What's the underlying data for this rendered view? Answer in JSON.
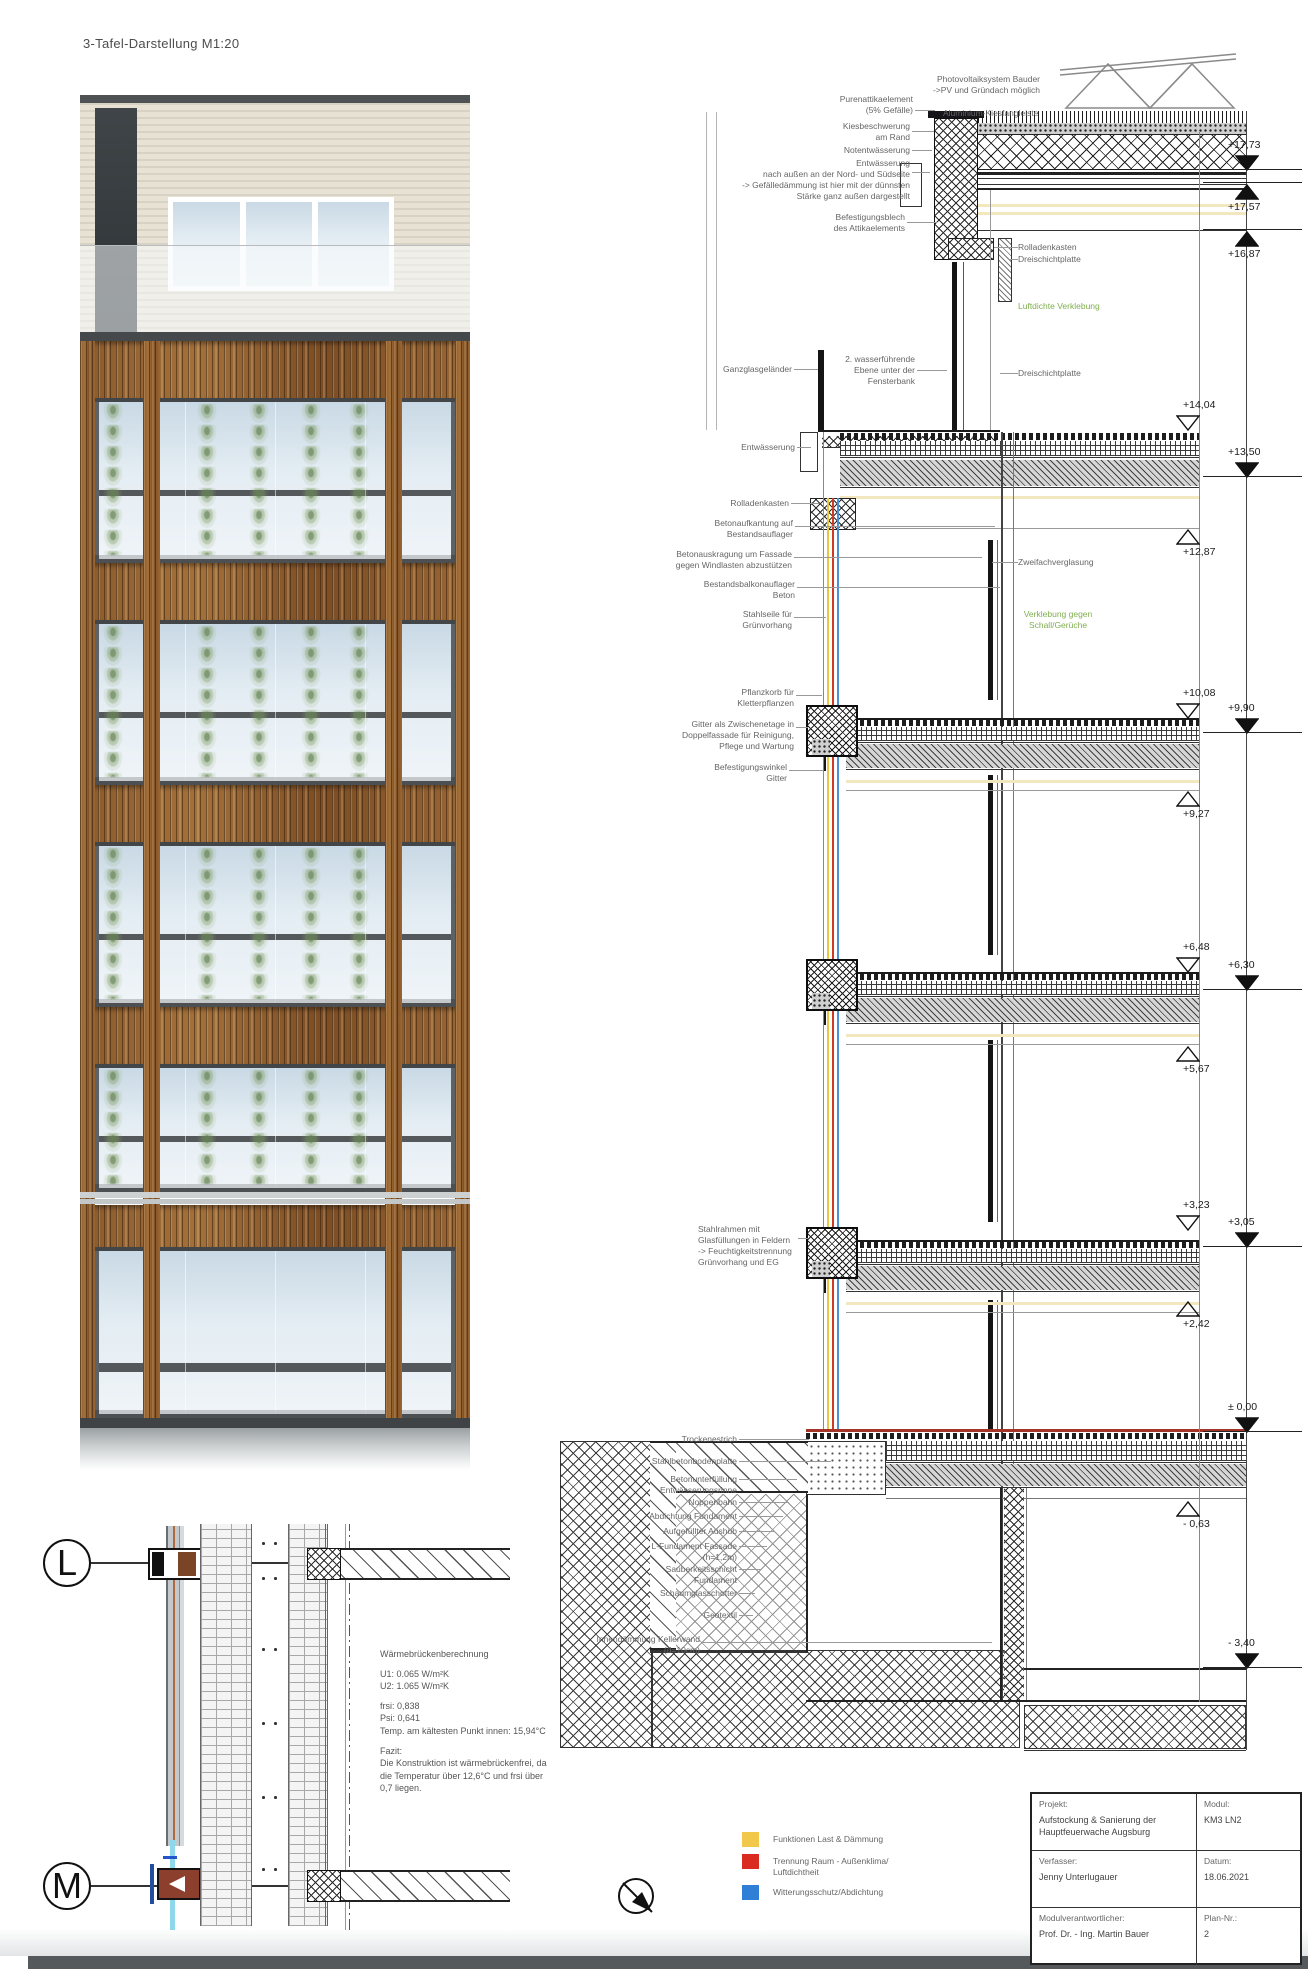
{
  "page": {
    "title": "3-Tafel-Darstellung M1:20"
  },
  "section": {
    "annotations": [
      {
        "t": "Photovoltaiksystem Bauder\n->PV und Gründach möglich",
        "x": 905,
        "y": 74,
        "w": 135,
        "a": "right",
        "lead": 0
      },
      {
        "t": "Purenattikaelement\n(5% Gefälle)",
        "x": 805,
        "y": 94,
        "w": 108,
        "a": "right",
        "lead": 20,
        "ldy": 16
      },
      {
        "t": "Aluminium-Kiesfangleiste",
        "x": 943,
        "y": 108,
        "w": 115,
        "a": "left",
        "lead": 0
      },
      {
        "t": "Kiesbeschwerung\nam Rand",
        "x": 800,
        "y": 121,
        "w": 110,
        "a": "right",
        "lead": 22,
        "ldy": 10
      },
      {
        "t": "Notentwässerung",
        "x": 800,
        "y": 145,
        "w": 110,
        "a": "right",
        "lead": 20,
        "ldy": 5
      },
      {
        "t": "Entwässerung\nnach außen an der Nord- und Südseite\n-> Gefälledämmung ist hier mit der dünnsten\nStärke ganz außen dargestellt",
        "x": 678,
        "y": 158,
        "w": 232,
        "a": "right",
        "lead": 18,
        "ldy": 14
      },
      {
        "t": "Befestigungsblech\ndes Attikaelements",
        "x": 795,
        "y": 212,
        "w": 110,
        "a": "right",
        "lead": 30,
        "ldy": 10
      },
      {
        "t": "Rolladenkasten",
        "x": 1018,
        "y": 242,
        "w": 95,
        "a": "left",
        "lead": -24,
        "ldy": 5
      },
      {
        "t": "Dreischichtplatte",
        "x": 1018,
        "y": 254,
        "w": 95,
        "a": "left",
        "lead": -10,
        "ldy": 5
      },
      {
        "t": "Luftdichte Verklebung",
        "x": 1018,
        "y": 301,
        "w": 110,
        "a": "left",
        "green": true,
        "lead": 0
      },
      {
        "t": "Ganzglasgeländer",
        "x": 712,
        "y": 364,
        "w": 80,
        "a": "right",
        "lead": 24,
        "ldy": 5
      },
      {
        "t": "2. wasserführende\nEbene unter der\nFensterbank",
        "x": 845,
        "y": 354,
        "w": 70,
        "a": "right",
        "lead": 30,
        "ldy": 16
      },
      {
        "t": "Dreischichtplatte",
        "x": 1018,
        "y": 368,
        "w": 95,
        "a": "left",
        "lead": -18,
        "ldy": 5
      },
      {
        "t": "Entwässerung",
        "x": 733,
        "y": 442,
        "w": 62,
        "a": "right",
        "lead": 14,
        "ldy": 5
      },
      {
        "t": "Rolladenkasten",
        "x": 723,
        "y": 498,
        "w": 66,
        "a": "right",
        "lead": 28,
        "ldy": 5
      },
      {
        "t": "Betonaufkantung auf\nBestandsauflager",
        "x": 710,
        "y": 518,
        "w": 83,
        "a": "right",
        "lead": 200,
        "ldy": 8
      },
      {
        "t": "Betonauskragung um Fassade\ngegen Windlasten abzustützen",
        "x": 668,
        "y": 549,
        "w": 124,
        "a": "right",
        "lead": 188,
        "ldy": 8
      },
      {
        "t": "Bestandsbalkonauflager\nBeton",
        "x": 700,
        "y": 579,
        "w": 95,
        "a": "right",
        "lead": 203,
        "ldy": 8
      },
      {
        "t": "Stahlseile für\nGrünvorhang",
        "x": 713,
        "y": 609,
        "w": 79,
        "a": "right",
        "lead": 32,
        "ldy": 8
      },
      {
        "t": "Zweifachverglasung",
        "x": 1018,
        "y": 557,
        "w": 100,
        "a": "left",
        "lead": -26,
        "ldy": 5
      },
      {
        "t": "Verklebung gegen\nSchall/Gerüche",
        "x": 1012,
        "y": 609,
        "w": 92,
        "a": "center",
        "green": true,
        "lead": 0
      },
      {
        "t": "Pflanzkorb für\nKletterpflanzen",
        "x": 710,
        "y": 687,
        "w": 84,
        "a": "right",
        "lead": 26,
        "ldy": 8
      },
      {
        "t": "Gitter als Zwischenetage in\nDoppelfassade für Reinigung,\nPflege und Wartung",
        "x": 666,
        "y": 719,
        "w": 128,
        "a": "right",
        "lead": 12,
        "ldy": 8
      },
      {
        "t": "Befestigungswinkel\nGitter",
        "x": 703,
        "y": 762,
        "w": 84,
        "a": "right",
        "lead": 34,
        "ldy": 8
      },
      {
        "t": "Stahlrahmen mit\nGlasfüllungen  in Feldern\n-> Feuchtigkeitstrennung\nGrünvorhang und EG",
        "x": 698,
        "y": 1224,
        "w": 98,
        "a": "left",
        "lead": 10,
        "ldy": 14
      },
      {
        "t": "Trockenestrich",
        "x": 610,
        "y": 1434,
        "w": 127,
        "a": "right",
        "lead": 70,
        "ldy": 5
      },
      {
        "t": "Stahlbetonbodenplatte",
        "x": 610,
        "y": 1456,
        "w": 127,
        "a": "right",
        "lead": 92,
        "ldy": 5
      },
      {
        "t": "Betonunterfüllung\nEntwässerungsrinne",
        "x": 610,
        "y": 1474,
        "w": 127,
        "a": "right",
        "lead": 58,
        "ldy": 5
      },
      {
        "t": "Noppenbahn",
        "x": 610,
        "y": 1497,
        "w": 127,
        "a": "right",
        "lead": 50,
        "ldy": 5
      },
      {
        "t": "Abdichtung Fundament",
        "x": 610,
        "y": 1511,
        "w": 127,
        "a": "right",
        "lead": 44,
        "ldy": 5
      },
      {
        "t": "Aufgefüllter Aushub",
        "x": 610,
        "y": 1526,
        "w": 127,
        "a": "right",
        "lead": 36,
        "ldy": 5
      },
      {
        "t": "L-Fundament Fassade\n(h=1,2m)",
        "x": 610,
        "y": 1541,
        "w": 127,
        "a": "right",
        "lead": 28,
        "ldy": 5
      },
      {
        "t": "Sauberkeitsschicht\nFundament",
        "x": 610,
        "y": 1564,
        "w": 127,
        "a": "right",
        "lead": 22,
        "ldy": 5
      },
      {
        "t": "Schaumglasschotter",
        "x": 610,
        "y": 1588,
        "w": 127,
        "a": "right",
        "lead": 16,
        "ldy": 5
      },
      {
        "t": "Geotextil",
        "x": 610,
        "y": 1610,
        "w": 127,
        "a": "right",
        "lead": 14,
        "ldy": 5
      },
      {
        "t": "Innendämmung Kellerwand\n(d=10cm)",
        "x": 575,
        "y": 1634,
        "w": 125,
        "a": "right",
        "lead": 290,
        "ldy": 8
      }
    ],
    "levels": [
      {
        "v": "+17,73",
        "y": 170,
        "tri": "df"
      },
      {
        "v": "+17,57",
        "y": 183,
        "tri": "uf"
      },
      {
        "v": "+16,87",
        "y": 230,
        "tri": "uf"
      },
      {
        "v": "+14,04",
        "y": 430,
        "tri": "do"
      },
      {
        "v": "+13,50",
        "y": 477,
        "tri": "df"
      },
      {
        "v": "+12,87",
        "y": 528,
        "tri": "uo"
      },
      {
        "v": "+10,08",
        "y": 718,
        "tri": "do"
      },
      {
        "v": "+9,90",
        "y": 733,
        "tri": "df"
      },
      {
        "v": "+9,27",
        "y": 790,
        "tri": "uo"
      },
      {
        "v": "+6,48",
        "y": 972,
        "tri": "do"
      },
      {
        "v": "+6,30",
        "y": 990,
        "tri": "df"
      },
      {
        "v": "+5,67",
        "y": 1045,
        "tri": "uo"
      },
      {
        "v": "+3,23",
        "y": 1230,
        "tri": "do"
      },
      {
        "v": "+3,05",
        "y": 1247,
        "tri": "df"
      },
      {
        "v": "+2,42",
        "y": 1300,
        "tri": "uo"
      },
      {
        "v": "± 0,00",
        "y": 1432,
        "tri": "df"
      },
      {
        "v": "- 0,63",
        "y": 1500,
        "tri": "uo"
      },
      {
        "v": "- 3,40",
        "y": 1668,
        "tri": "df"
      }
    ]
  },
  "detail": {
    "marker_top": "L",
    "marker_bottom": "M",
    "calc_lines": [
      "Wärmebrückenberechnung",
      "",
      "U1: 0.065 W/m²K",
      "U2: 1.065 W/m²K",
      "",
      "frsi: 0,838",
      "Psi: 0,641",
      "Temp. am kältesten Punkt innen: 15,94°C",
      "",
      "Fazit:",
      "Die Konstruktion ist wärmebrückenfrei, da",
      "die Temperatur über 12,6°C und frsi über",
      "0,7 liegen."
    ]
  },
  "legend": {
    "items": [
      {
        "color": "#F2C84B",
        "label": "Funktionen Last & Dämmung"
      },
      {
        "color": "#D92B1F",
        "label": "Trennung Raum - Außenklima/\nLuftdichtheit"
      },
      {
        "color": "#2F7FD6",
        "label": "Witterungsschutz/Abdichtung"
      }
    ]
  },
  "titleblock": {
    "rows": [
      {
        "label": "Projekt:",
        "value": "Aufstockung & Sanierung der\nHauptfeuerwache Augsburg",
        "label2": "Modul:",
        "value2": "KM3 LN2"
      },
      {
        "label": "Verfasser:",
        "value": "Jenny Unterlugauer",
        "label2": "Datum:",
        "value2": "18.06.2021"
      },
      {
        "label": "Modulverantwortlicher:",
        "value": "Prof. Dr. - Ing. Martin Bauer",
        "label2": "Plan-Nr.:",
        "value2": "2"
      }
    ]
  }
}
